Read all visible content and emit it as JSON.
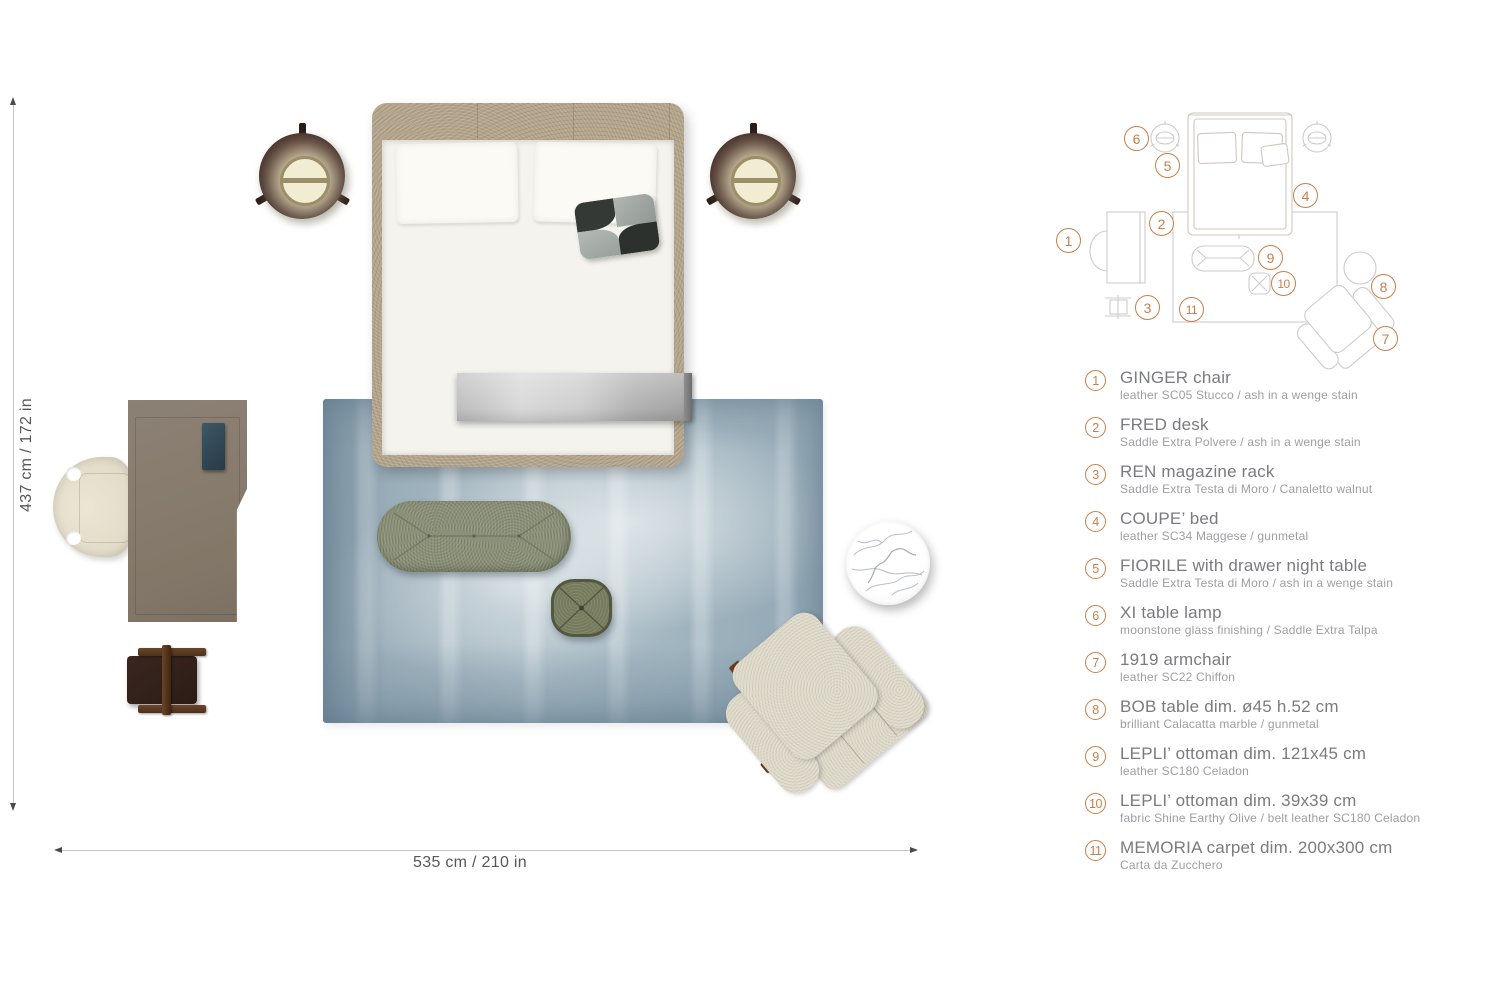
{
  "dimensions": {
    "height_label": "437 cm / 172 in",
    "width_label": "535 cm / 210 in"
  },
  "diagram": {
    "badges": [
      "1",
      "2",
      "3",
      "4",
      "5",
      "6",
      "7",
      "8",
      "9",
      "10",
      "11"
    ]
  },
  "legend": {
    "items": [
      {
        "num": "1",
        "name": "GINGER chair",
        "spec": "leather SC05 Stucco / ash in a wenge stain"
      },
      {
        "num": "2",
        "name": "FRED desk",
        "spec": "Saddle Extra Polvere / ash in a wenge stain"
      },
      {
        "num": "3",
        "name": "REN magazine rack",
        "spec": "Saddle Extra Testa di Moro / Canaletto walnut"
      },
      {
        "num": "4",
        "name": "COUPE’ bed",
        "spec": "leather SC34 Maggese / gunmetal"
      },
      {
        "num": "5",
        "name": "FIORILE with drawer night table",
        "spec": "Saddle Extra Testa di Moro / ash in a wenge stain"
      },
      {
        "num": "6",
        "name": "XI table lamp",
        "spec": "moonstone glass finishing / Saddle Extra Talpa"
      },
      {
        "num": "7",
        "name": "1919 armchair",
        "spec": "leather SC22 Chiffon"
      },
      {
        "num": "8",
        "name": "BOB table dim. ø45 h.52 cm",
        "spec": "brilliant Calacatta marble / gunmetal"
      },
      {
        "num": "9",
        "name": "LEPLI’ ottoman dim. 121x45 cm",
        "spec": "leather SC180 Celadon"
      },
      {
        "num": "10",
        "name": "LEPLI’ ottoman dim. 39x39 cm",
        "spec": "fabric Shine Earthy Olive / belt leather SC180 Celadon"
      },
      {
        "num": "11",
        "name": "MEMORIA carpet dim. 200x300 cm",
        "spec": "Carta da Zucchero"
      }
    ]
  },
  "colors": {
    "accent_orange": "#c5804a",
    "legend_name_gray": "#7a7b7e",
    "legend_spec_gray": "#9d9ea1",
    "carpet_blue": "#a7b7c1",
    "bed_frame_leather": "#b2a48b",
    "night_table_brown": "#46302a",
    "lamp_glow_cream": "#f2ecd2",
    "desk_taupe": "#877c71",
    "chair_cream": "#e9e2d0",
    "rack_leather_dark": "#2f1f19",
    "rack_walnut": "#5d3b22",
    "ottoman_celadon": "#8b9078",
    "ottoman_olive": "#767b5d",
    "armchair_chiffon": "#ded9c9",
    "runner_silver": "#c6c6c6",
    "diagram_line_gray": "#cccccc"
  }
}
